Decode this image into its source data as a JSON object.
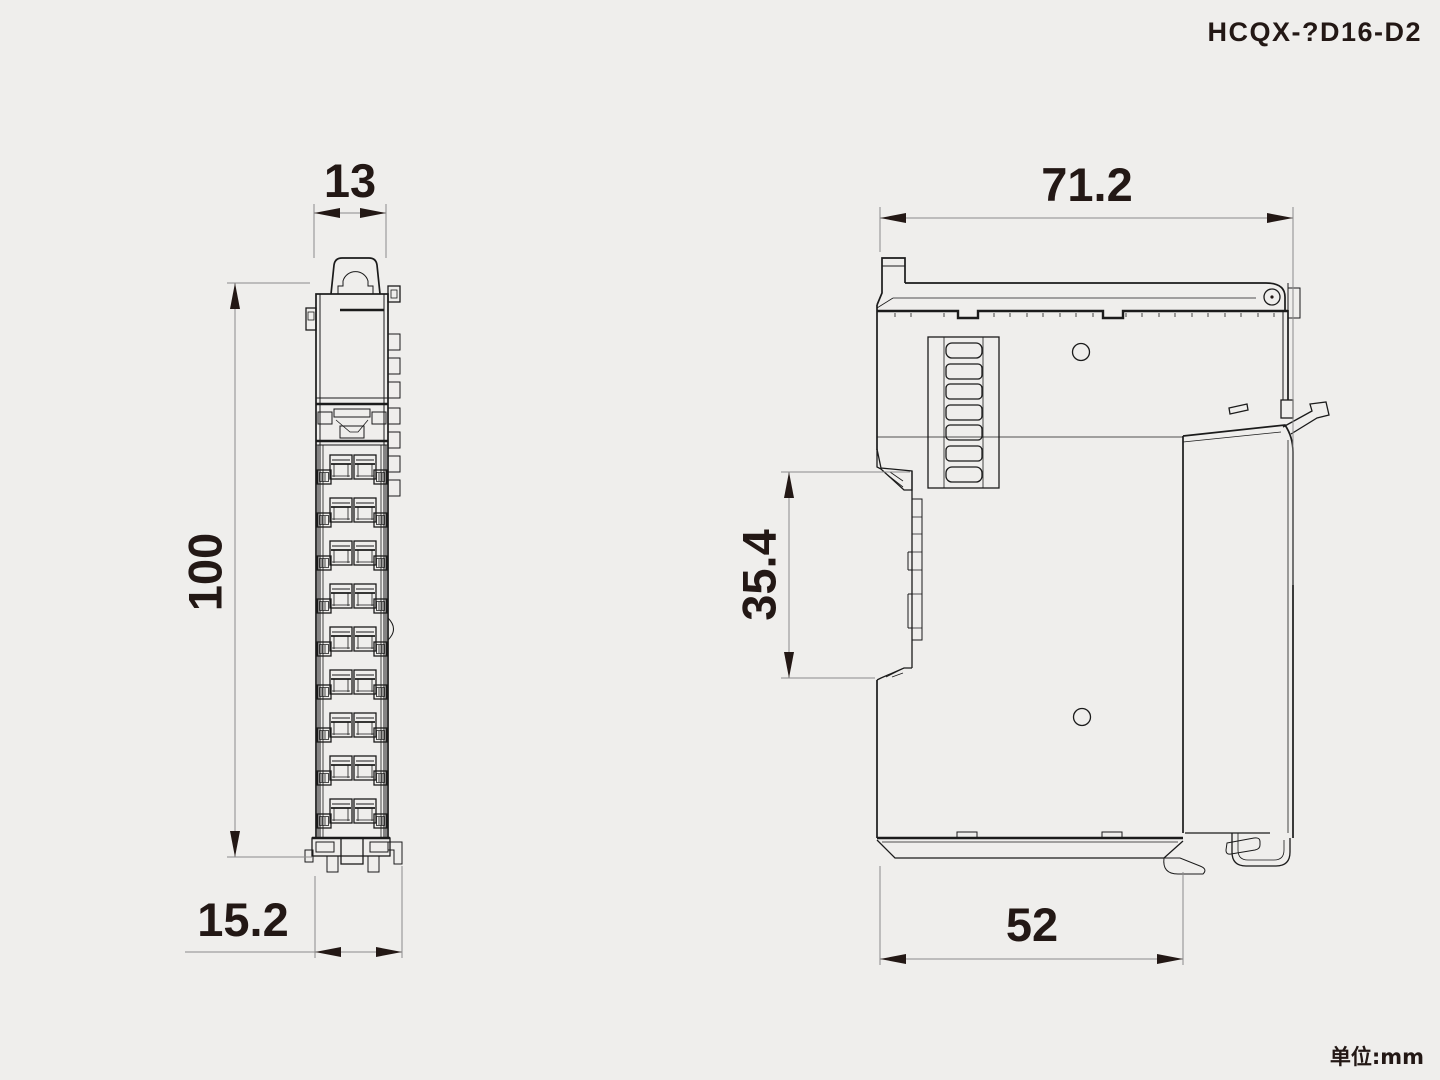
{
  "title": "HCQX-?D16-D2",
  "unit_label": "单位:mm",
  "drawing": {
    "front_view": {
      "dim_width_top": "13",
      "dim_height": "100",
      "dim_width_bottom": "15.2"
    },
    "side_view": {
      "dim_width_top": "71.2",
      "dim_notch_height": "35.4",
      "dim_width_bottom": "52"
    }
  },
  "colors": {
    "background": "#efeeec",
    "drawing_line": "#1b1b1b",
    "dimension_line": "#8b8b8b",
    "label_text": "#231815"
  }
}
